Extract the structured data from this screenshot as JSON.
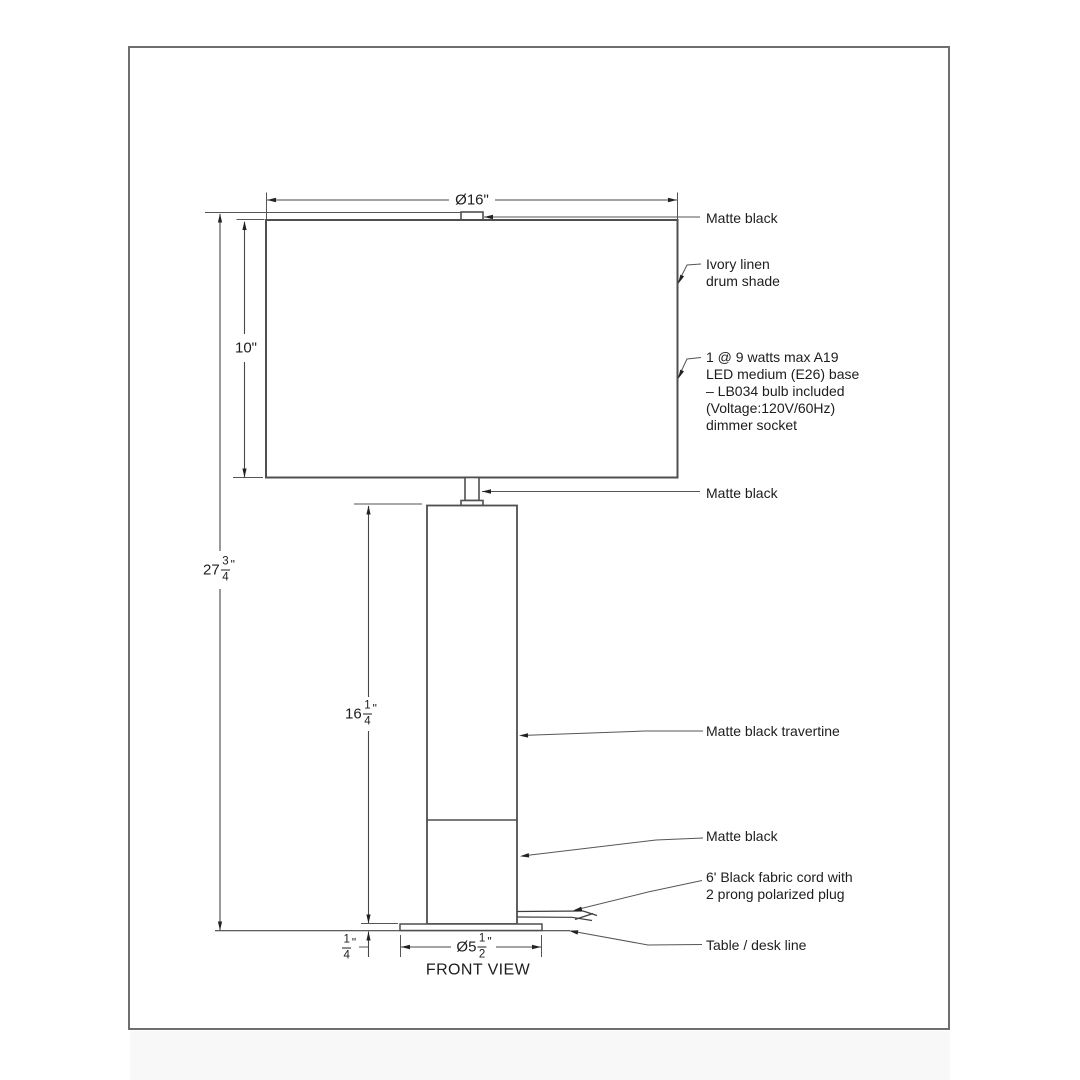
{
  "drawing": {
    "view_label": "FRONT VIEW",
    "dimensions": {
      "shade_diameter_label": "Ø16\"",
      "shade_height_label": "10\"",
      "overall_height": {
        "whole": "27",
        "num": "3",
        "den": "4",
        "unit": "\""
      },
      "body_height": {
        "whole": "16",
        "num": "1",
        "den": "4",
        "unit": "\""
      },
      "base_height": {
        "whole": "",
        "num": "1",
        "den": "4",
        "unit": "\""
      },
      "base_diameter": {
        "whole": "Ø5",
        "num": "1",
        "den": "2",
        "unit": "\""
      }
    },
    "annotations": {
      "shade_top_finish": "Matte black",
      "shade_material": [
        "Ivory linen",
        "drum shade"
      ],
      "bulb_spec": [
        "1 @ 9 watts max A19",
        "LED medium (E26) base",
        "– LB034 bulb included",
        "(Voltage:120V/60Hz)",
        "dimmer socket"
      ],
      "neck_finish": "Matte black",
      "body_material": "Matte black travertine",
      "base_finish": "Matte black",
      "cord_spec": [
        "6' Black fabric cord with",
        "2 prong polarized plug"
      ],
      "table_line_label": "Table / desk line"
    },
    "colors": {
      "outline": "#4f4f4f",
      "dimension_line": "#474747",
      "arrow": "#222222",
      "text": "#1d1d1d",
      "frame": "#6e6e6e",
      "background": "#ffffff"
    }
  }
}
